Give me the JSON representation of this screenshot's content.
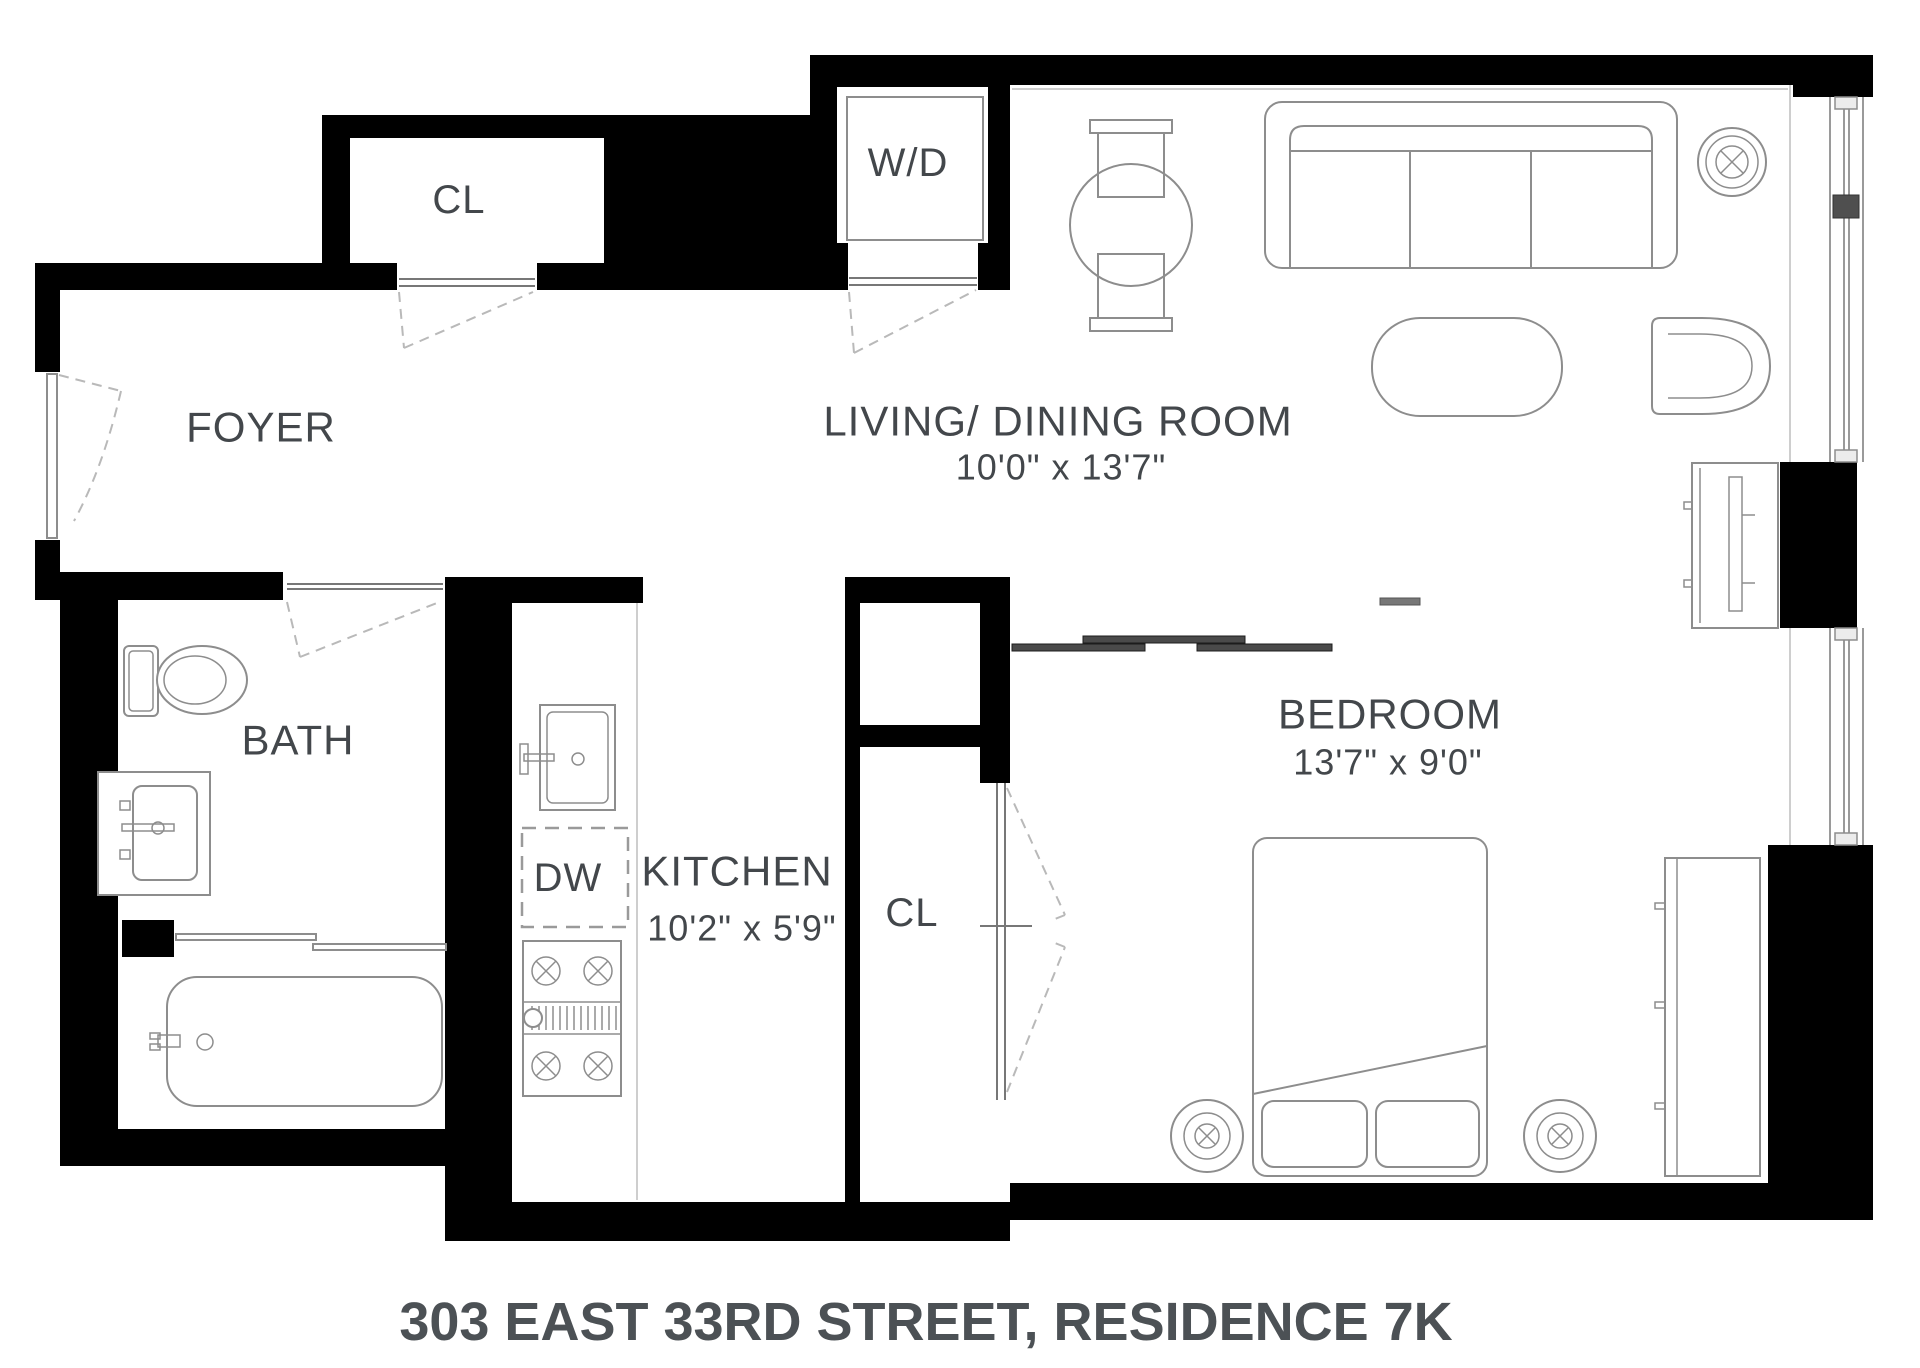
{
  "floorplan": {
    "title": "303 EAST 33RD STREET, RESIDENCE 7K",
    "rooms": {
      "foyer": {
        "label": "FOYER"
      },
      "living_dining": {
        "label": "LIVING/ DINING ROOM",
        "dimensions": "10'0\" x 13'7\""
      },
      "bedroom": {
        "label": "BEDROOM",
        "dimensions": "13'7\" x 9'0\""
      },
      "kitchen": {
        "label": "KITCHEN",
        "dimensions": "10'2\" x 5'9\""
      },
      "bath": {
        "label": "BATH"
      },
      "closet_foyer": {
        "label": "CL"
      },
      "closet_bedroom": {
        "label": "CL"
      },
      "washer_dryer": {
        "label": "W/D"
      },
      "dishwasher": {
        "label": "DW"
      }
    },
    "colors": {
      "wall": "#000000",
      "furniture-line": "#8d8d8d",
      "label-text": "#43474b",
      "title-text": "#4c5155",
      "dashed-line": "#b9b9b9",
      "slider-bar": "#4a4a4a"
    }
  }
}
